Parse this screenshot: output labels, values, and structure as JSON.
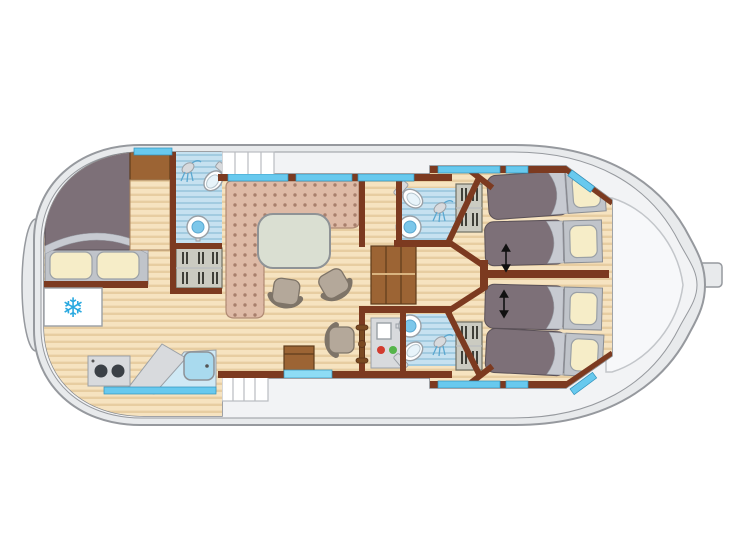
{
  "meta": {
    "kind": "boat-floor-plan",
    "orientation": "bow-left-stern-right",
    "has_text_labels": false
  },
  "icons": {
    "snowflake": "❄"
  },
  "colors": {
    "hull": "#e8eaec",
    "hull-line": "#96999e",
    "deck": "#f2f3f5",
    "deck2": "#f7f8fa",
    "deck-line": "#c3c6ca",
    "cabin-bg": "#fdfdfd",
    "cabin-line": "#84878c",
    "wall": "#7c3a20",
    "floor": "#f6e3c0",
    "floor-line": "#e7cda1",
    "bath-floor": "#c6e1f0",
    "bath-line": "#a2cbe0",
    "window": "#68c9ee",
    "door": "#8edcf5",
    "bed": "#7d7078",
    "bed-fold": "#c7cad1",
    "pillow": "#f6edc8",
    "pillow-frame": "#c0c4ca",
    "sofa": "#debaa6",
    "sofa-dot": "#a87f6c",
    "table": "#dadfd2",
    "chair": "#b4a89a",
    "chair-line": "#7e7468",
    "steel": "#d8dadd",
    "steel-line": "#9aa0a6",
    "wood-furn": "#9c6434",
    "wood-furn-line": "#5f3c1c",
    "cabinet": "#cbcbc1",
    "cabinet-line": "#6f6f64",
    "snowflake": "#2aa9e0",
    "red": "#d23b2f",
    "green": "#55b44a",
    "burner": "#3b4046",
    "arrow": "#111111"
  },
  "plan": {
    "rooms": [
      {
        "id": "bow-cabin",
        "furniture": [
          "double-bed",
          "2-pillows",
          "wardrobe",
          "refrigerator"
        ]
      },
      {
        "id": "bathroom-fore",
        "fixtures": [
          "shower",
          "toilet",
          "washbasin"
        ],
        "storage": [
          "wardrobe-with-hangers"
        ]
      },
      {
        "id": "galley",
        "fixtures": [
          "2-burner-stove",
          "angled-worktop",
          "sink"
        ]
      },
      {
        "id": "saloon",
        "furniture": [
          "l-shaped-bench",
          "oval-table",
          "2-chairs",
          "storage-box"
        ]
      },
      {
        "id": "helm-station",
        "furniture": [
          "swivel-seat",
          "steering-wheel",
          "instrument-console"
        ],
        "console_lights": [
          "red",
          "green"
        ]
      },
      {
        "id": "companionway",
        "features": [
          "interior-stairs",
          "deck-steps-fore",
          "deck-steps-aft"
        ]
      },
      {
        "id": "bathroom-aft-top",
        "fixtures": [
          "shower",
          "toilet",
          "washbasin"
        ],
        "storage": [
          "hanging-locker"
        ]
      },
      {
        "id": "bathroom-aft-bottom",
        "fixtures": [
          "shower",
          "toilet",
          "washbasin"
        ],
        "storage": [
          "hanging-locker"
        ]
      },
      {
        "id": "aft-cabin-top",
        "furniture": [
          "2-single-beds"
        ],
        "annotation": "double-arrow-sliding-beds"
      },
      {
        "id": "aft-cabin-bottom",
        "furniture": [
          "2-single-beds"
        ],
        "annotation": "double-arrow-sliding-beds"
      },
      {
        "id": "stern-deck"
      }
    ],
    "counts": {
      "double_beds": 1,
      "single_beds": 4,
      "bathrooms": 3
    },
    "exterior": [
      "bow-fender",
      "rudder",
      "side-windows",
      "entry-door"
    ]
  }
}
